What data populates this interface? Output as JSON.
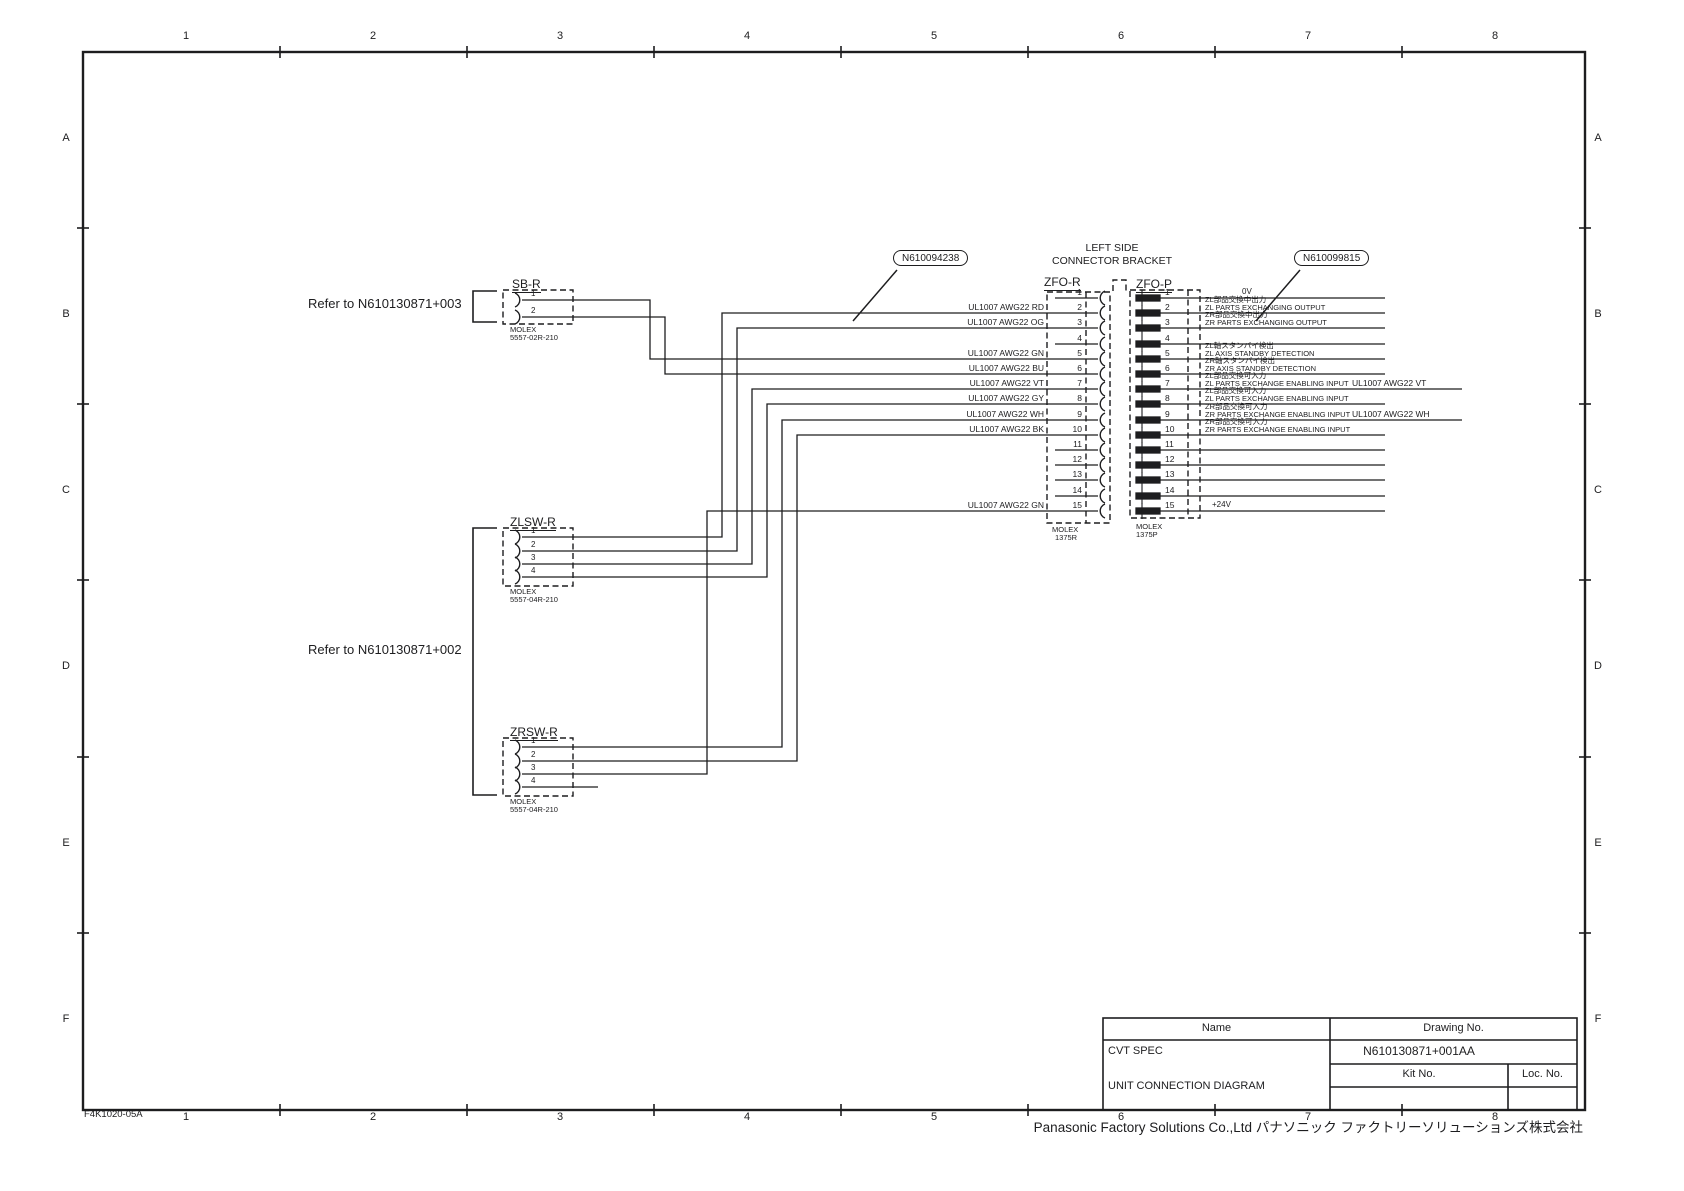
{
  "page": {
    "form_no": "F4K1020-05A",
    "footer": "Panasonic Factory Solutions Co.,Ltd パナソニック ファクトリーソリューションズ株式会社",
    "zone_cols": [
      "1",
      "2",
      "3",
      "4",
      "5",
      "6",
      "7",
      "8"
    ],
    "zone_rows": [
      "A",
      "B",
      "C",
      "D",
      "E",
      "F"
    ]
  },
  "title_block": {
    "name_header": "Name",
    "drawing_no_header": "Drawing No.",
    "name": "CVT SPEC",
    "drawing_no": "N610130871+001AA",
    "title": "UNIT CONNECTION DIAGRAM",
    "kit_no_header": "Kit No.",
    "loc_no_header": "Loc. No."
  },
  "notes": {
    "refer_top": "Refer to N610130871+003",
    "refer_bottom": "Refer to N610130871+002",
    "balloon_left": "N610094238",
    "balloon_right": "N610099815",
    "bracket_title": [
      "LEFT SIDE",
      "CONNECTOR BRACKET"
    ]
  },
  "connectors": {
    "sb_r": {
      "label": "SB-R",
      "pins": [
        "1",
        "2"
      ],
      "maker": "MOLEX",
      "part": "5557-02R-210"
    },
    "zlsw_r": {
      "label": "ZLSW-R",
      "pins": [
        "1",
        "2",
        "3",
        "4"
      ],
      "maker": "MOLEX",
      "part": "5557-04R-210"
    },
    "zrsw_r": {
      "label": "ZRSW-R",
      "pins": [
        "1",
        "2",
        "3",
        "4"
      ],
      "maker": "MOLEX",
      "part": "5557-04R-210"
    },
    "zfo_r": {
      "label": "ZFO-R",
      "maker": "MOLEX",
      "part": "1375R"
    },
    "zfo_p": {
      "label": "ZFO-P",
      "maker": "MOLEX",
      "part": "1375P"
    }
  },
  "zfo_rows": [
    {
      "pin": "1",
      "left_wire": "",
      "jp": "",
      "en": "",
      "tag": "0V",
      "right_wire": ""
    },
    {
      "pin": "2",
      "left_wire": "UL1007 AWG22 RD",
      "jp": "ZL部品交換中出力",
      "en": "ZL PARTS EXCHANGING OUTPUT",
      "tag": "",
      "right_wire": ""
    },
    {
      "pin": "3",
      "left_wire": "UL1007 AWG22 OG",
      "jp": "ZR部品交換中出力",
      "en": "ZR PARTS EXCHANGING OUTPUT",
      "tag": "",
      "right_wire": ""
    },
    {
      "pin": "4",
      "left_wire": "",
      "jp": "",
      "en": "",
      "tag": "",
      "right_wire": ""
    },
    {
      "pin": "5",
      "left_wire": "UL1007 AWG22 GN",
      "jp": "ZL軸スタンバイ検出",
      "en": "ZL AXIS STANDBY DETECTION",
      "tag": "",
      "right_wire": ""
    },
    {
      "pin": "6",
      "left_wire": "UL1007 AWG22 BU",
      "jp": "ZR軸スタンバイ検出",
      "en": "ZR AXIS STANDBY DETECTION",
      "tag": "",
      "right_wire": ""
    },
    {
      "pin": "7",
      "left_wire": "UL1007 AWG22 VT",
      "jp": "ZL部品交換可入力",
      "en": "ZL PARTS EXCHANGE ENABLING INPUT",
      "tag": "",
      "right_wire": "UL1007 AWG22 VT"
    },
    {
      "pin": "8",
      "left_wire": "UL1007 AWG22 GY",
      "jp": "ZL部品交換可入力",
      "en": "ZL PARTS EXCHANGE ENABLING INPUT",
      "tag": "",
      "right_wire": ""
    },
    {
      "pin": "9",
      "left_wire": "UL1007 AWG22 WH",
      "jp": "ZR部品交換可入力",
      "en": "ZR PARTS EXCHANGE ENABLING INPUT",
      "tag": "",
      "right_wire": "UL1007 AWG22 WH"
    },
    {
      "pin": "10",
      "left_wire": "UL1007 AWG22 BK",
      "jp": "ZR部品交換可入力",
      "en": "ZR PARTS EXCHANGE ENABLING INPUT",
      "tag": "",
      "right_wire": ""
    },
    {
      "pin": "11",
      "left_wire": "",
      "jp": "",
      "en": "",
      "tag": "",
      "right_wire": ""
    },
    {
      "pin": "12",
      "left_wire": "",
      "jp": "",
      "en": "",
      "tag": "",
      "right_wire": ""
    },
    {
      "pin": "13",
      "left_wire": "",
      "jp": "",
      "en": "",
      "tag": "",
      "right_wire": ""
    },
    {
      "pin": "14",
      "left_wire": "",
      "jp": "",
      "en": "",
      "tag": "",
      "right_wire": ""
    },
    {
      "pin": "15",
      "left_wire": "UL1007 AWG22 GN",
      "jp": "",
      "en": "",
      "tag": "+24V",
      "right_wire": ""
    }
  ]
}
